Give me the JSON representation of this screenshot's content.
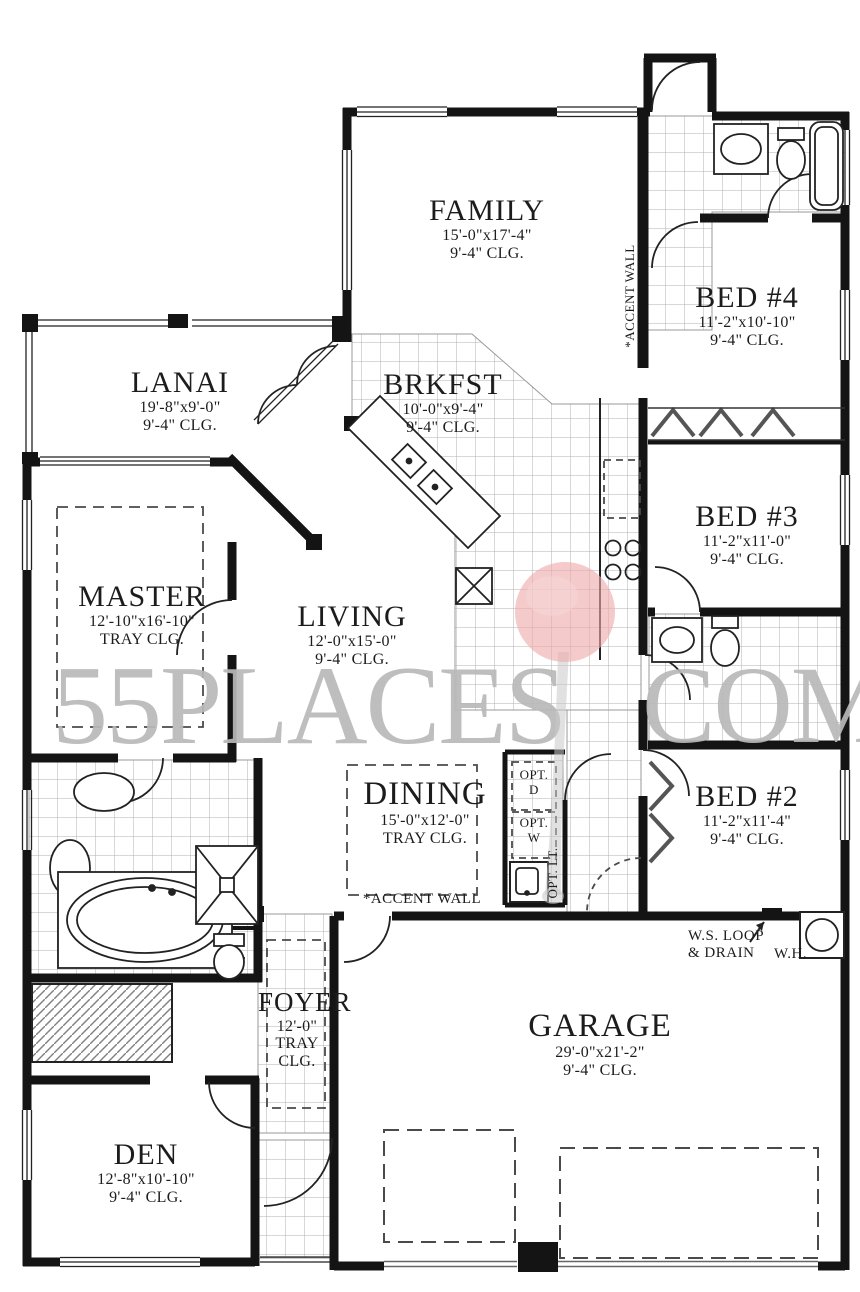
{
  "plan": {
    "rooms": [
      {
        "id": "family",
        "name": "FAMILY",
        "dims": "15'-0\"x17'-4\"",
        "clg": "9'-4\" CLG."
      },
      {
        "id": "lanai",
        "name": "LANAI",
        "dims": "19'-8\"x9'-0\"",
        "clg": "9'-4\" CLG."
      },
      {
        "id": "brkfst",
        "name": "BRKFST",
        "dims": "10'-0\"x9'-4\"",
        "clg": "9'-4\" CLG."
      },
      {
        "id": "bed4",
        "name": "BED #4",
        "dims": "11'-2\"x10'-10\"",
        "clg": "9'-4\" CLG."
      },
      {
        "id": "bed3",
        "name": "BED #3",
        "dims": "11'-2\"x11'-0\"",
        "clg": "9'-4\" CLG."
      },
      {
        "id": "master",
        "name": "MASTER",
        "dims": "12'-10\"x16'-10\"",
        "clg": "TRAY CLG."
      },
      {
        "id": "living",
        "name": "LIVING",
        "dims": "12'-0\"x15'-0\"",
        "clg": "9'-4\" CLG."
      },
      {
        "id": "dining",
        "name": "DINING",
        "dims": "15'-0\"x12'-0\"",
        "clg": "TRAY CLG."
      },
      {
        "id": "bed2",
        "name": "BED #2",
        "dims": "11'-2\"x11'-4\"",
        "clg": "9'-4\" CLG."
      },
      {
        "id": "foyer",
        "name": "FOYER",
        "dims": "12'-0\"",
        "clg": "TRAY CLG."
      },
      {
        "id": "garage",
        "name": "GARAGE",
        "dims": "29'-0\"x21'-2\"",
        "clg": "9'-4\" CLG."
      },
      {
        "id": "den",
        "name": "DEN",
        "dims": "12'-8\"x10'-10\"",
        "clg": "9'-4\" CLG."
      }
    ],
    "annotations": {
      "accent_wall_family": "*ACCENT WALL",
      "accent_wall_dining": "*ACCENT WALL",
      "opt_dryer_line1": "OPT.",
      "opt_dryer_line2": "D",
      "opt_washer_line1": "OPT.",
      "opt_washer_line2": "W",
      "opt_laundry_tub": "OPT. LT.",
      "ws_loop_line1": "W.S. LOOP",
      "ws_loop_line2": "& DRAIN",
      "water_heater": "W.H."
    },
    "watermark": {
      "left": "55PLACES",
      "right": "COM"
    },
    "colors": {
      "wall": "#141414",
      "tile_line": "#a8a8a8",
      "watermark": "#b9b9b9",
      "balloon": "#eeaaaa"
    }
  }
}
